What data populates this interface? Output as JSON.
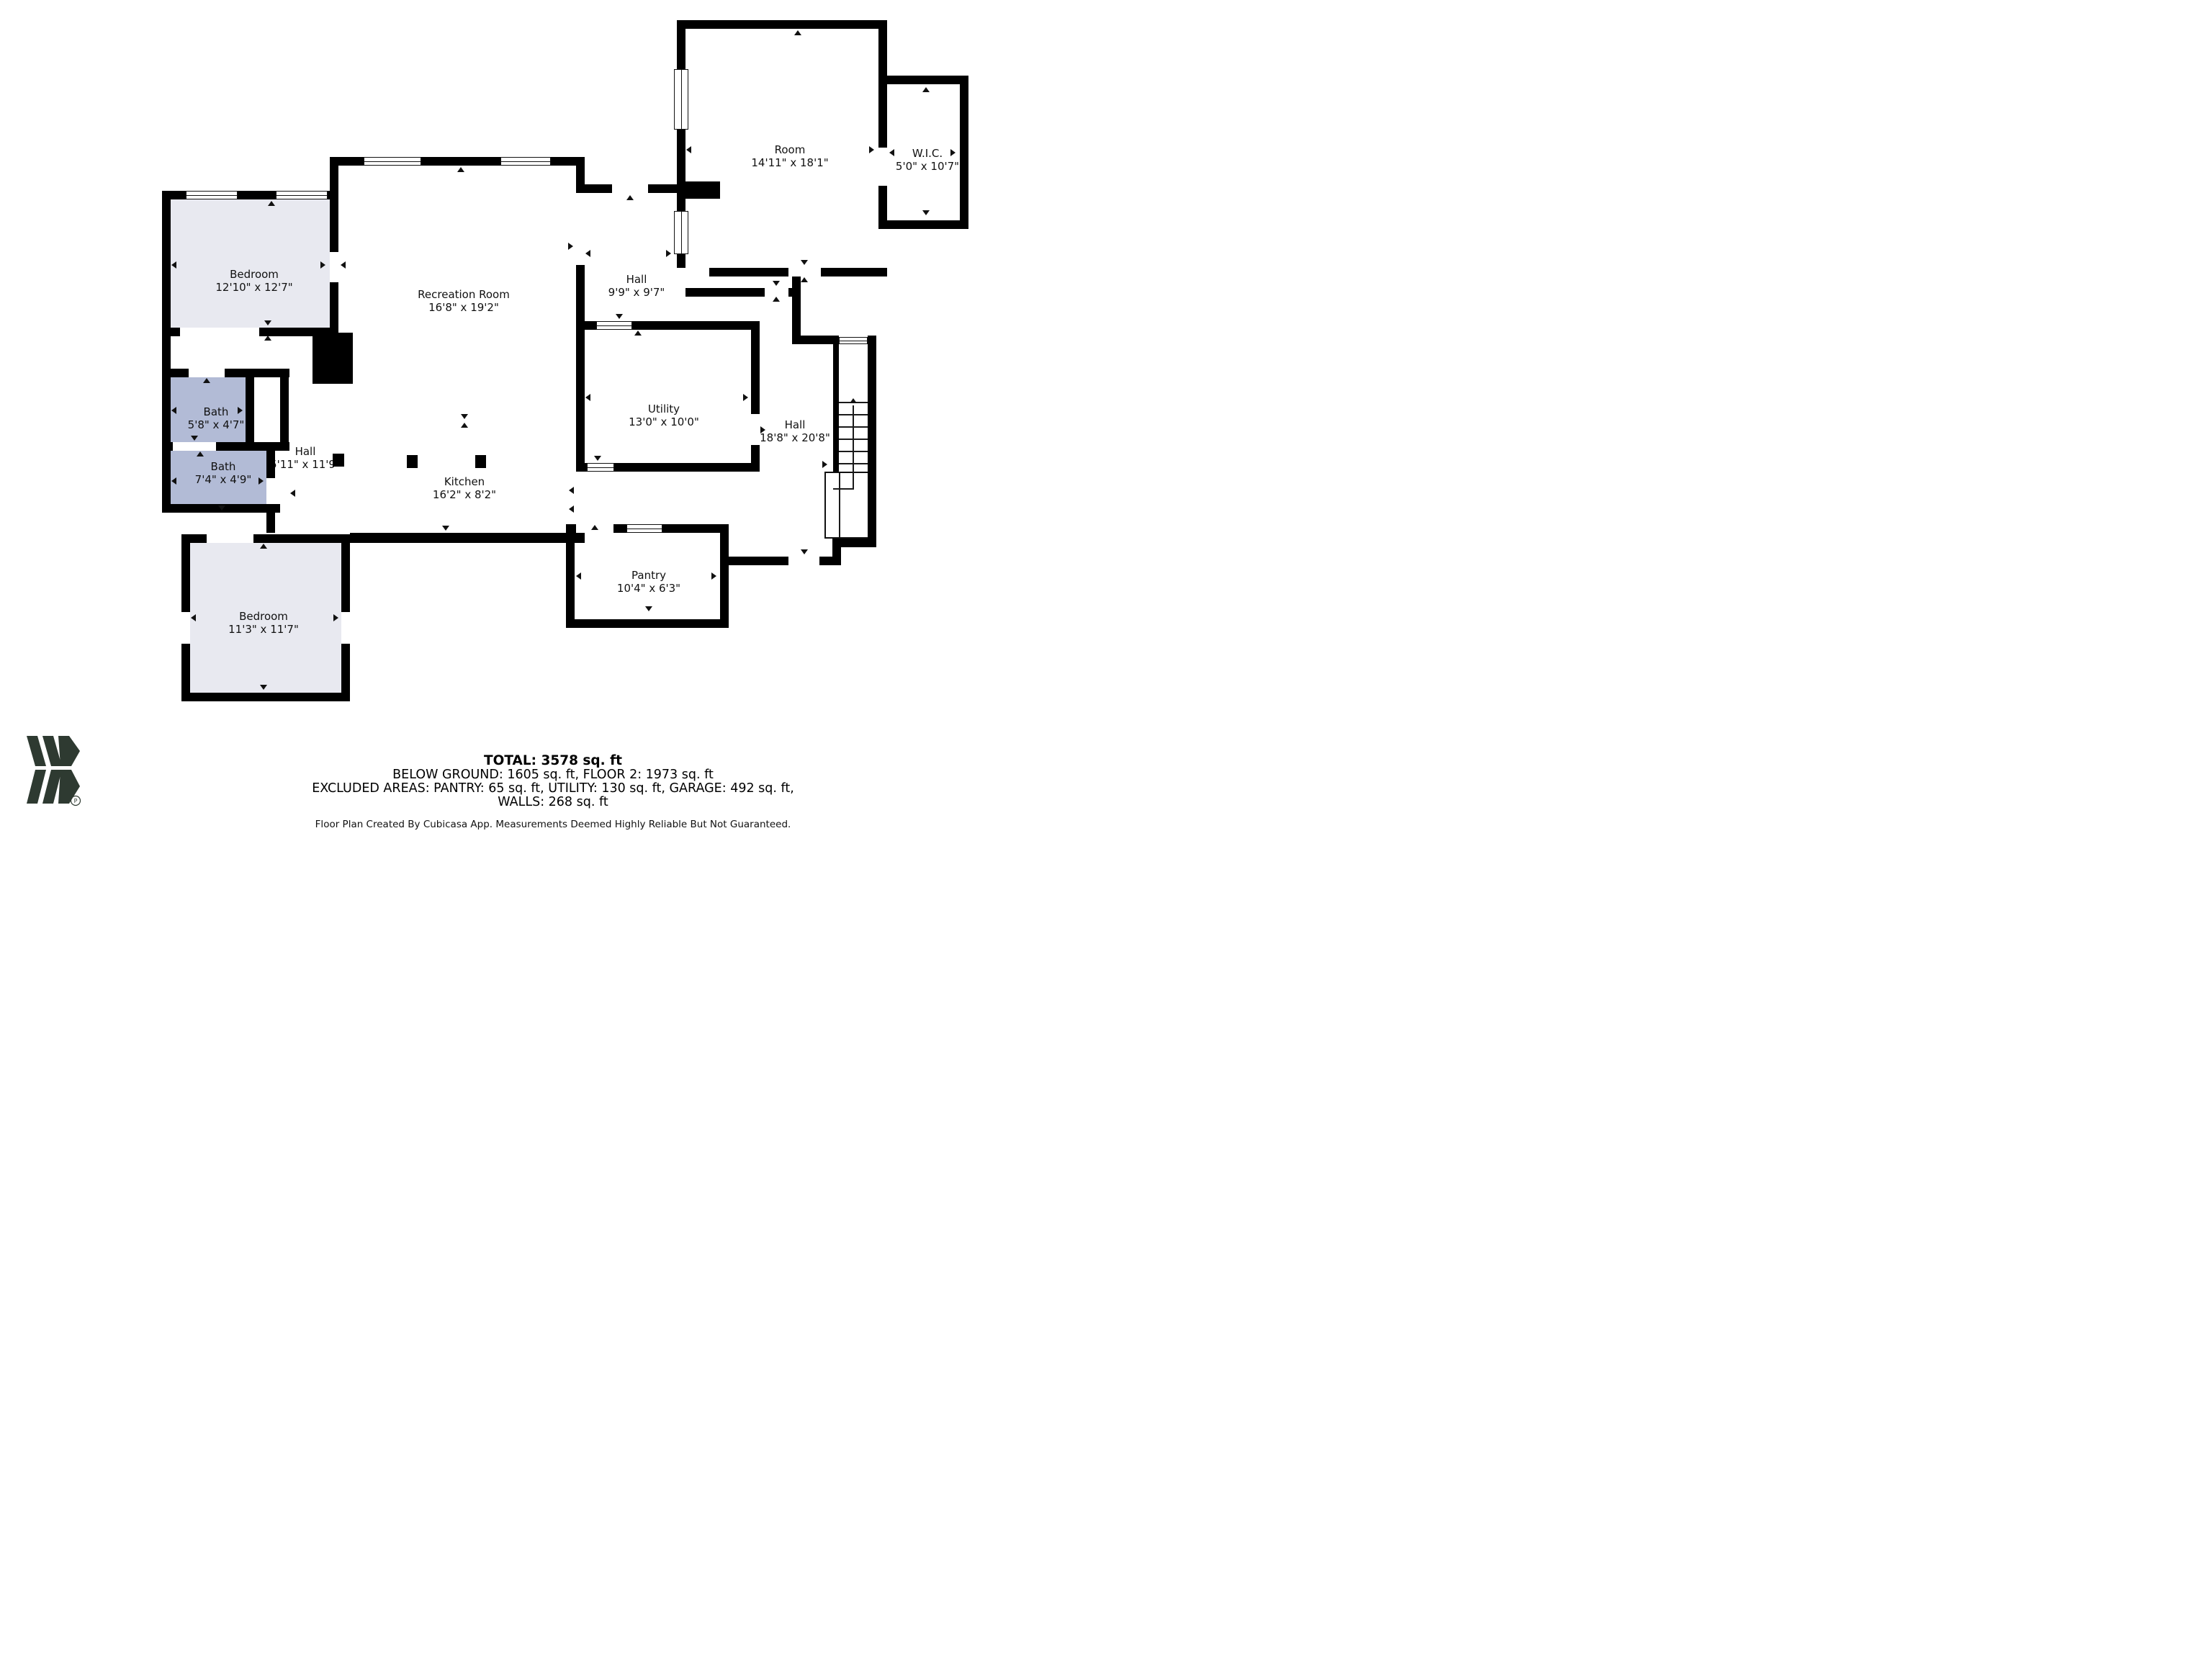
{
  "title": "Floor plan",
  "rooms": [
    {
      "id": "bedroom-1",
      "name": "Bedroom",
      "dims": "12'10\" x 12'7\""
    },
    {
      "id": "recreation-room",
      "name": "Recreation Room",
      "dims": "16'8\" x 19'2\""
    },
    {
      "id": "room",
      "name": "Room",
      "dims": "14'11\" x 18'1\""
    },
    {
      "id": "wic",
      "name": "W.I.C.",
      "dims": "5'0\" x 10'7\""
    },
    {
      "id": "hall-upper",
      "name": "Hall",
      "dims": "9'9\" x 9'7\""
    },
    {
      "id": "bath-1",
      "name": "Bath",
      "dims": "5'8\" x 4'7\""
    },
    {
      "id": "bath-2",
      "name": "Bath",
      "dims": "7'4\" x 4'9\""
    },
    {
      "id": "hall-center",
      "name": "Hall",
      "dims": "5'11\" x 11'9\""
    },
    {
      "id": "kitchen",
      "name": "Kitchen",
      "dims": "16'2\" x 8'2\""
    },
    {
      "id": "utility",
      "name": "Utility",
      "dims": "13'0\" x 10'0\""
    },
    {
      "id": "hall-right",
      "name": "Hall",
      "dims": "18'8\" x 20'8\""
    },
    {
      "id": "pantry",
      "name": "Pantry",
      "dims": "10'4\" x 6'3\""
    },
    {
      "id": "bedroom-2",
      "name": "Bedroom",
      "dims": "11'3\" x 11'7\""
    }
  ],
  "footer": {
    "total": "TOTAL: 3578 sq. ft",
    "below_ground": "BELOW GROUND: 1605 sq. ft, FLOOR 2: 1973 sq. ft",
    "excluded": "EXCLUDED AREAS: PANTRY: 65 sq. ft, UTILITY: 130 sq. ft, GARAGE: 492 sq. ft,",
    "walls": "WALLS: 268 sq. ft",
    "disclaimer": "Floor Plan Created By Cubicasa App. Measurements Deemed Highly Reliable But Not Guaranteed."
  },
  "colors": {
    "wall": "#000000",
    "bedroom_fill": "#e8e9f0",
    "bath_fill": "#b2bbd6",
    "logo": "#2e3a31"
  }
}
